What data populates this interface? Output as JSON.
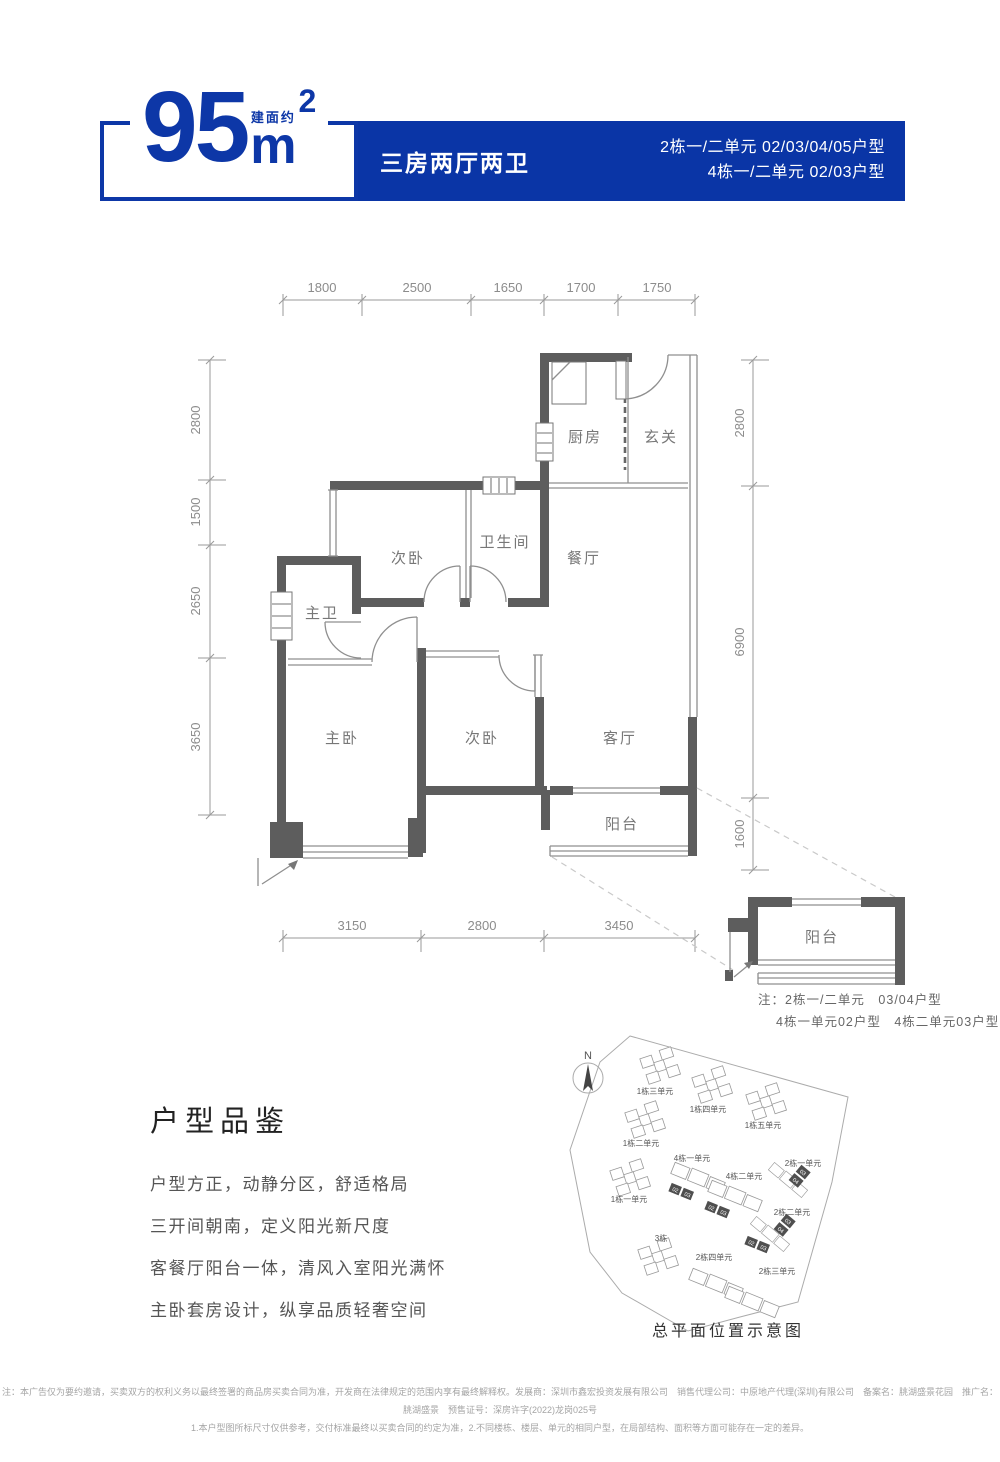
{
  "brand": {
    "blue": "#0a35a6"
  },
  "header": {
    "area_value": "95",
    "area_prefix": "建面约",
    "area_unit": "m",
    "area_sup": "2",
    "layout": "三房两厅两卫",
    "units_line1": "2栋一/二单元 02/03/04/05户型",
    "units_line2": "4栋一/二单元 02/03户型"
  },
  "floorplan": {
    "dims_top": [
      "1800",
      "2500",
      "1650",
      "1700",
      "1750"
    ],
    "dims_left": [
      "2800",
      "1500",
      "2650",
      "3650"
    ],
    "dims_right": [
      "2800",
      "6900",
      "1600"
    ],
    "dims_bottom": [
      "3150",
      "2800",
      "3450"
    ],
    "rooms": {
      "kitchen": "厨房",
      "entry": "玄关",
      "bedroom2": "次卧",
      "bathroom": "卫生间",
      "dining": "餐厅",
      "master_bath": "主卫",
      "master_bedroom": "主卧",
      "bedroom3": "次卧",
      "living": "客厅",
      "balcony": "阳台"
    }
  },
  "balcony_detail": {
    "label": "阳台",
    "note_line1": "注：2栋一/二单元　03/04户型",
    "note_line2": "4栋一单元02户型　4栋二单元03户型"
  },
  "features": {
    "title": "户型品鉴",
    "lines": [
      "户型方正，动静分区，舒适格局",
      "三开间朝南，定义阳光新尺度",
      "客餐厅阳台一体，清风入室阳光满怀",
      "主卧套房设计，纵享品质轻奢空间"
    ]
  },
  "siteplan": {
    "compass": "N",
    "caption": "总平面位置示意图",
    "buildings": [
      {
        "label": "1栋三单元"
      },
      {
        "label": "1栋四单元"
      },
      {
        "label": "1栋五单元"
      },
      {
        "label": "1栋二单元"
      },
      {
        "label": "4栋一单元"
      },
      {
        "label": "4栋二单元"
      },
      {
        "label": "2栋一单元"
      },
      {
        "label": "1栋一单元"
      },
      {
        "label": "2栋二单元"
      },
      {
        "label": "3栋"
      },
      {
        "label": "2栋四单元"
      },
      {
        "label": "2栋三单元"
      }
    ],
    "tiles": [
      "02",
      "03",
      "02",
      "03",
      "03",
      "04",
      "02",
      "03",
      "03",
      "04"
    ]
  },
  "footer": {
    "line1": "注：本广告仅为要约邀请，买卖双方的权利义务以最终签署的商品房买卖合同为准，开发商在法律规定的范围内享有最终解释权。发展商：深圳市鑫宏投资发展有限公司　销售代理公司：中原地产代理(深圳)有限公司　备案名：朓湖盛景花园　推广名：朓湖盛景　预售证号：深房许字(2022)龙岗025号",
    "line2": "1.本户型图所标尺寸仅供参考，交付标准最终以买卖合同的约定为准，2.不同楼栋、楼层、单元的相同户型，在局部结构、面积等方面可能存在一定的差异。"
  }
}
